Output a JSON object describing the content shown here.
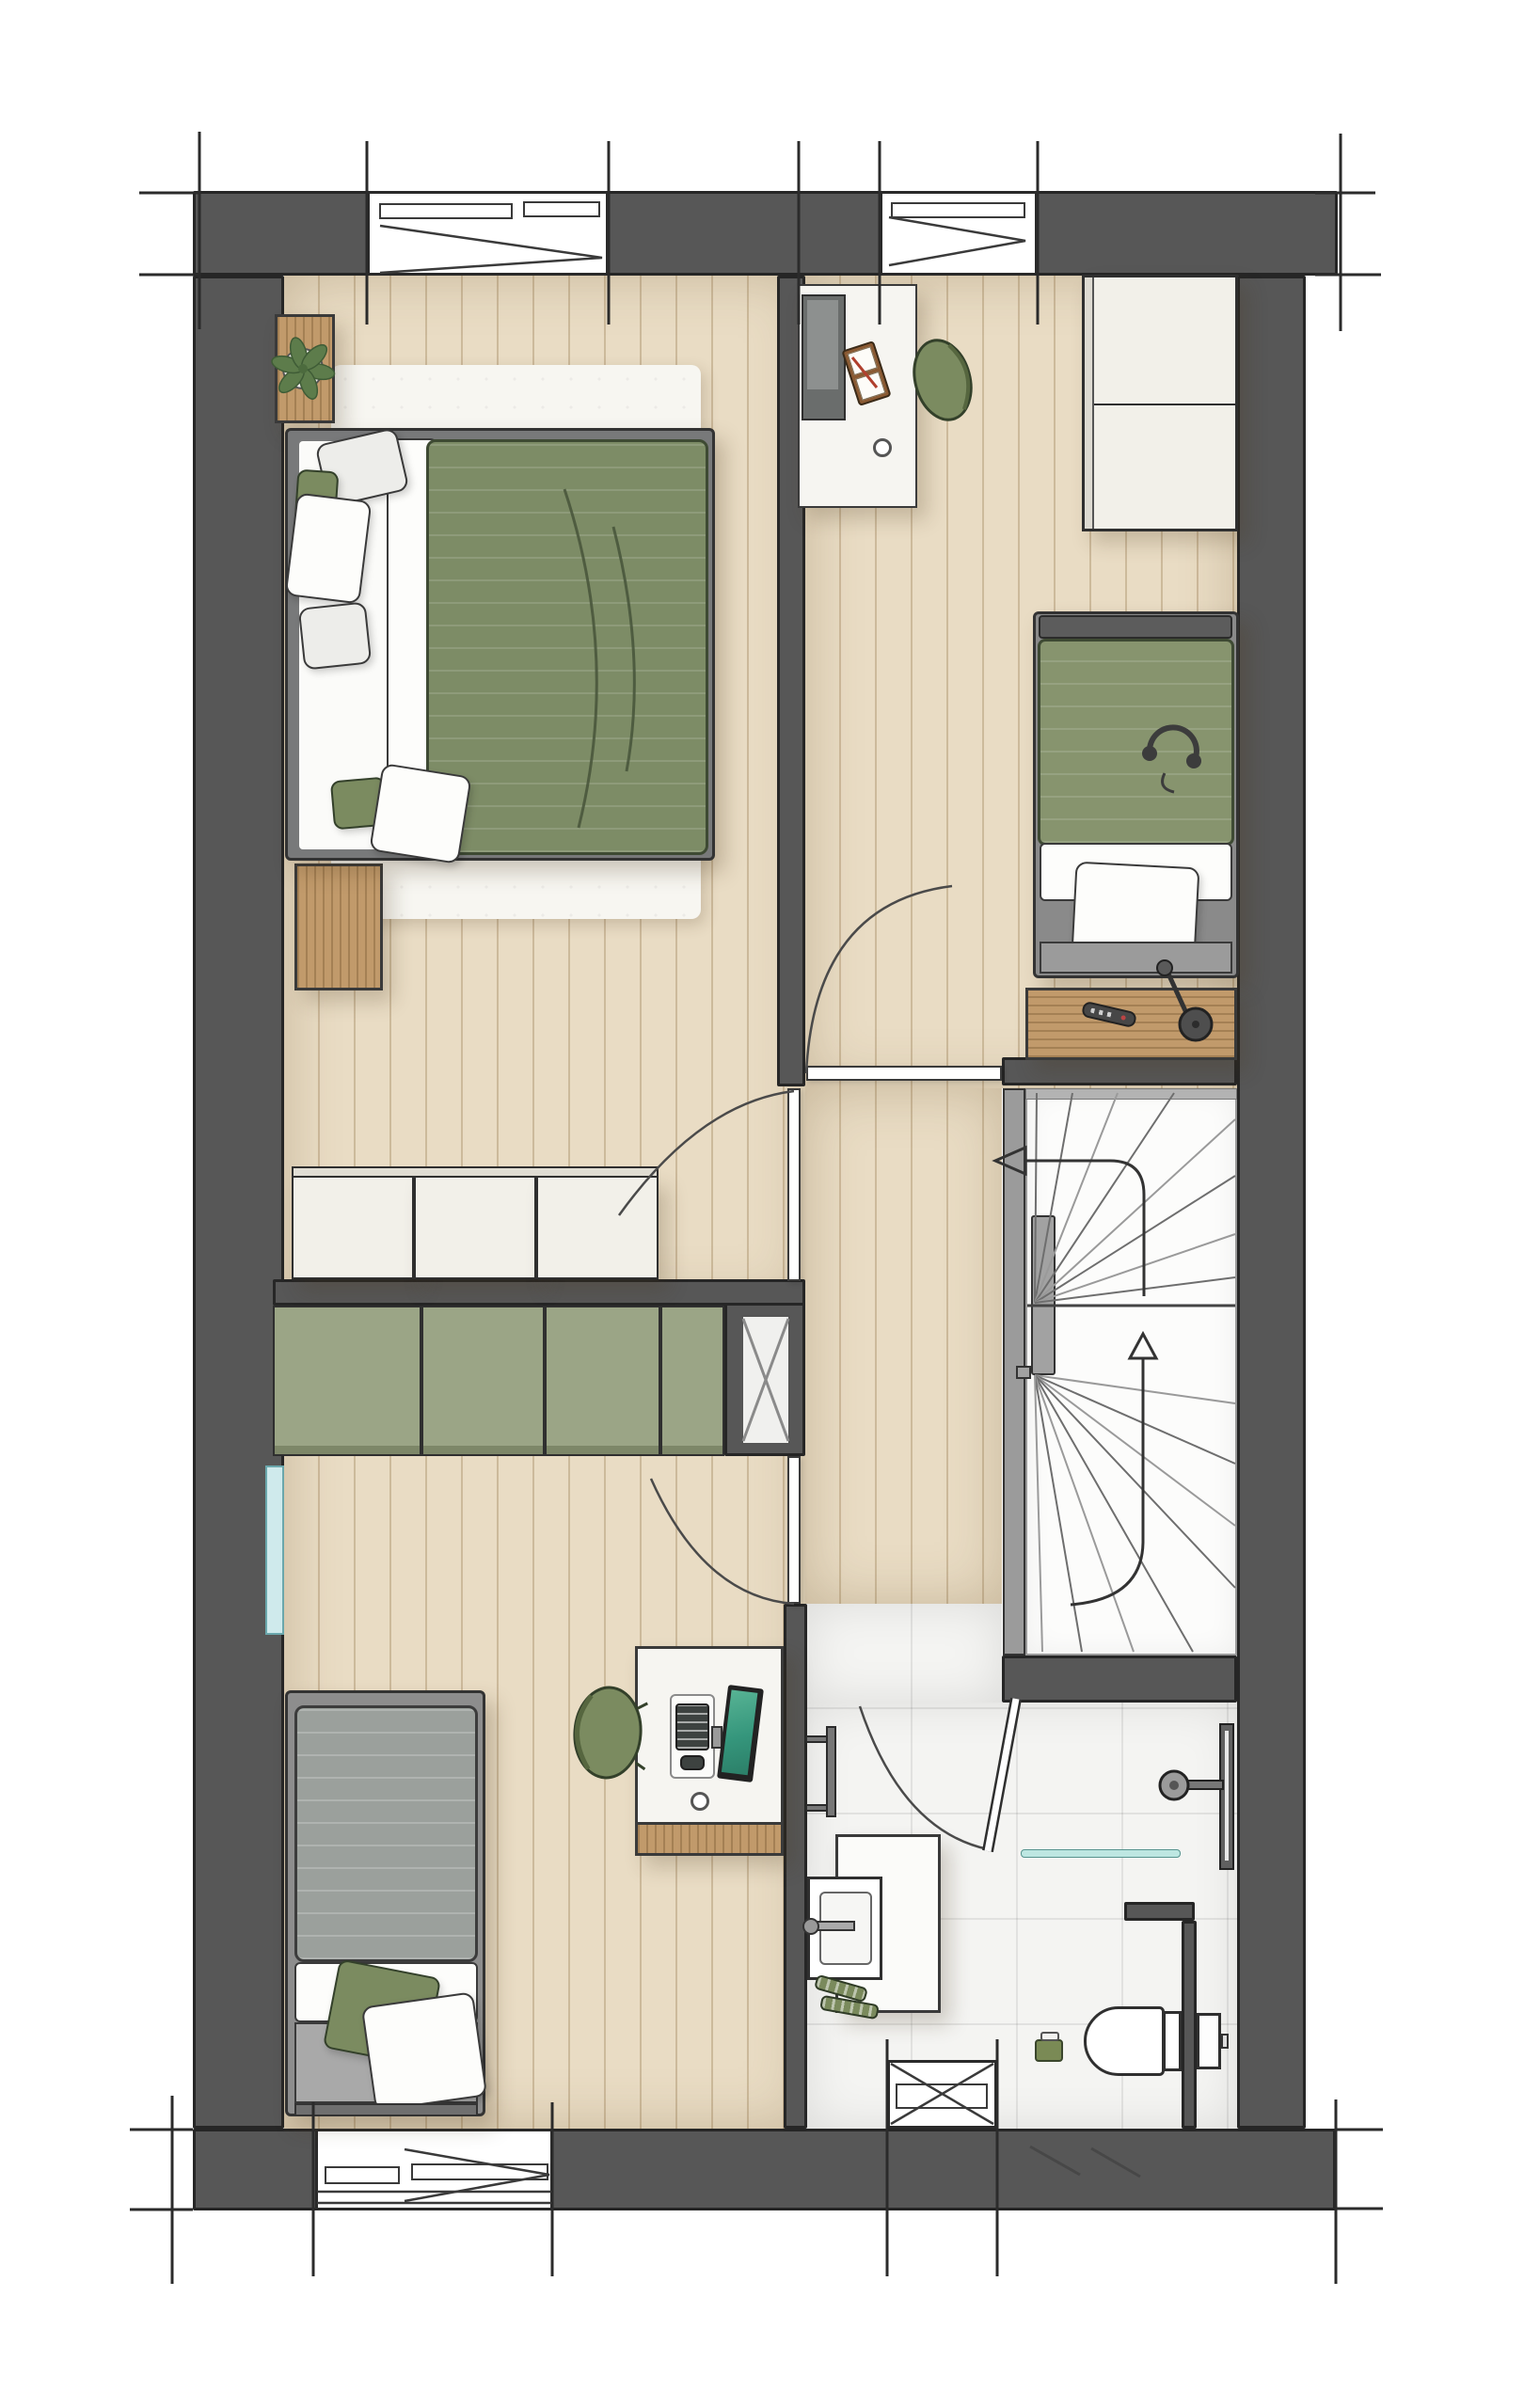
{
  "meta": {
    "title": "Hand-drawn first-floor plan with two bedrooms, landing, winder staircase and bathroom",
    "kind": "architectural floor plan illustration",
    "visible_text": "none"
  },
  "colors": {
    "wall": "#575757",
    "wallEdge": "#262626",
    "ink": "#2b2b2b",
    "floor": "#e9dcc4",
    "plankLine": "rgba(138,106,61,0.30)",
    "rug": "#f7f6f1",
    "linen": "#fdfdfb",
    "duvetGreen": "#7d8c66",
    "duvetGreenLight": "#87946e",
    "duvetGray": "#9ba09c",
    "frameGray": "#78797a",
    "wood": "#c19a6b",
    "woodDark": "#9b7242",
    "cabinetWhite": "#f2f0e9",
    "cabinetGreen": "#9ba586",
    "tile": "#f4f4f2",
    "glass": "#bde7e2",
    "windowBlue": "#cfeaec",
    "chairGreen": "#7b8b60",
    "plantGreen": "#5d7c4b",
    "screenTeal": "#46a489",
    "stairBg": "#fcfcfb",
    "railGray": "#9b9b9b",
    "arrowInk": "#333333"
  },
  "rooms": [
    {
      "id": "bedroom-master",
      "label": "Master bedroom (top left): double bed with green duvet, two wooden nightstands, plant, white rug, 3-door white wardrobe"
    },
    {
      "id": "bedroom-top-right",
      "label": "Bedroom (top right): desk with monitor and book, green desk chair, 2-door wardrobe, single bed with green duvet and headphones, wooden side shelf with lamp and remote"
    },
    {
      "id": "bedroom-bottom-left",
      "label": "Bedroom (bottom left): single bed with gray duvet, desk with TV, keyboard and mouse, green desk chair, green 4-door low cabinet, side window"
    },
    {
      "id": "landing",
      "label": "Landing / corridor with doors to all rooms"
    },
    {
      "id": "stairwell",
      "label": "Winder staircase with newel, tread fan lines and up/down direction arrows"
    },
    {
      "id": "bathroom",
      "label": "Bathroom: vanity with washbasin and wall faucet, toiletry bottles, towel radiator, walk-in shower with head, wall drain and glass screen, wall-hung toilet with concealed cistern, toilet brush, window"
    }
  ],
  "doors": [
    {
      "id": "door-bedroom-top-right",
      "swing": "into top-right bedroom"
    },
    {
      "id": "door-bedroom-master",
      "swing": "into master bedroom"
    },
    {
      "id": "door-bedroom-bottom-left",
      "swing": "into bottom-left bedroom"
    },
    {
      "id": "door-bathroom",
      "swing": "into bathroom"
    }
  ],
  "windows": [
    {
      "id": "window-top-left",
      "wall": "north"
    },
    {
      "id": "window-top-right",
      "wall": "north"
    },
    {
      "id": "window-bottom-left",
      "wall": "south"
    },
    {
      "id": "window-bathroom",
      "wall": "south"
    },
    {
      "id": "window-side-strip",
      "wall": "west"
    }
  ],
  "shaft": {
    "id": "service-shaft",
    "symbol": "rectangle with X"
  },
  "stairs": {
    "arrows": [
      "up",
      "down-exit-left"
    ],
    "style": "winder fan treads around central newel"
  }
}
